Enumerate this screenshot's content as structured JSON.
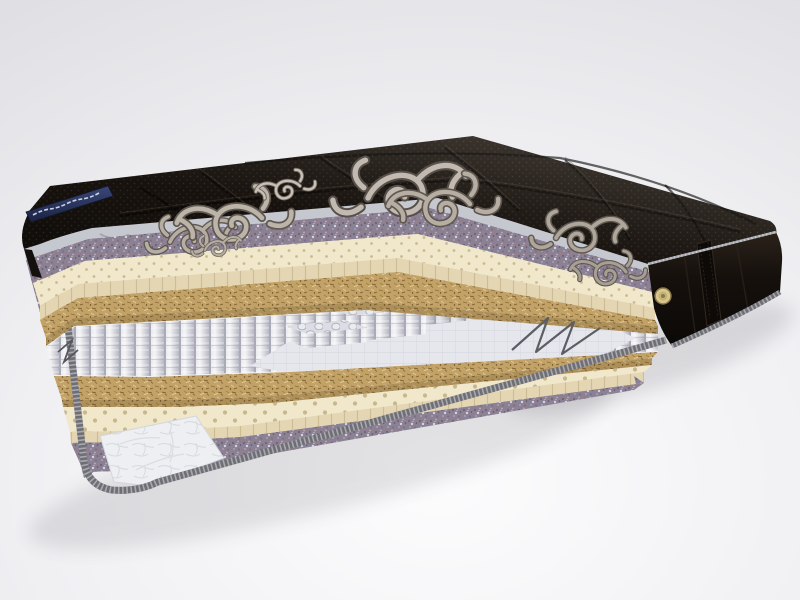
{
  "image": {
    "type": "3d-product-render",
    "subject": "mattress cross-section cutaway",
    "background_color": "#ebebee",
    "description": "Cutaway 3D render of a mattress showing internal layers: black quilted damask top cover, felt pad, perforated latex foam, coconut coir, independent pocket-spring core with stepped cut blocks and zig-zag steel wire, then coir, latex, felt and a white quilted bottom cover with striped grey piping. Black side border with round air vent and vertical handle strap. Navy brand ribbon on the front-left top edge."
  },
  "mattress": {
    "top_cover": {
      "part": "quilted top cover",
      "fabric_color": "#1a1410",
      "ornament": "silver damask scroll pattern",
      "ornament_color": "#b3aba0",
      "quilting": "puffy diamond channels with pin-dot knit"
    },
    "brand_ribbon": {
      "part": "brand label ribbon",
      "color": "#2c3763",
      "location": "front-left top edge",
      "text_legible": false
    },
    "layers_top_to_bottom": [
      {
        "name": "quilted cover backing ruffle",
        "color": "#c7c9d0"
      },
      {
        "name": "felt padding",
        "color": "#8b8193"
      },
      {
        "name": "perforated latex foam",
        "color": "#f1e7cb"
      },
      {
        "name": "coconut coir",
        "color": "#c2a266"
      },
      {
        "name": "independent pocket springs",
        "color": "#e8e9ee"
      },
      {
        "name": "coconut coir",
        "color": "#c2a266"
      },
      {
        "name": "perforated latex foam",
        "color": "#f1e7cb"
      },
      {
        "name": "felt padding",
        "color": "#8b8193"
      },
      {
        "name": "quilted bottom cover",
        "color": "#edeff1"
      }
    ],
    "side_panel": {
      "part": "black side border",
      "color": "#17120e",
      "air_vent_color": "#d7c78d",
      "handle": "vertical fabric strap",
      "piping": "grey striped edge piping"
    },
    "spring_detail": {
      "stepped_blocks": 3,
      "steel_wire": "zig-zag frame wire on right cross-section"
    }
  },
  "aria": {
    "image_label": "Cutaway 3D render of a mattress: black quilted damask top, felt, perforated latex, coconut coir, pocket spring core with stepped blocks, coir, latex, felt and white quilted bottom cover with grey piping; black side border with air vent and handle."
  }
}
